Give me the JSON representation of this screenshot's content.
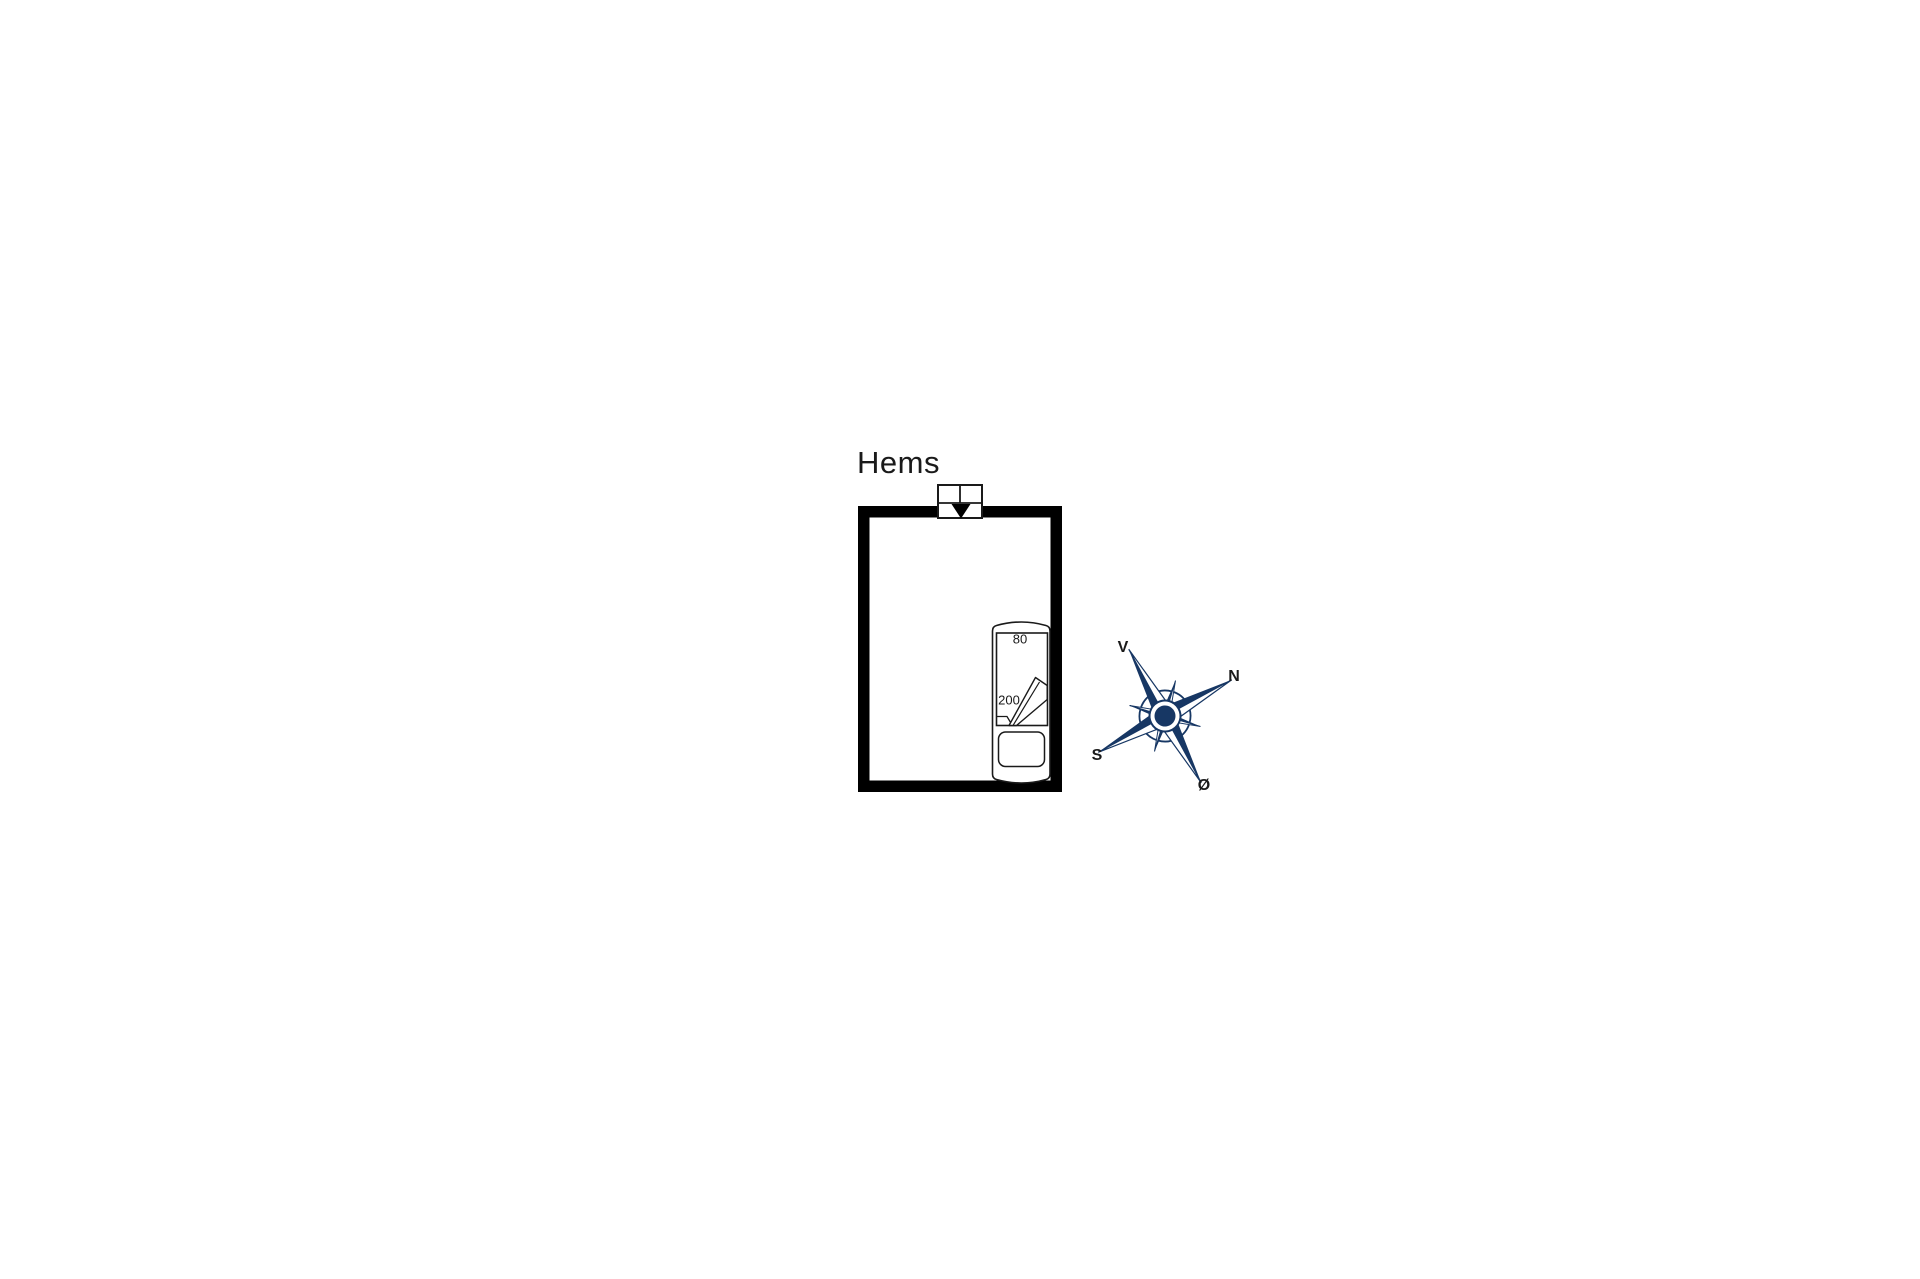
{
  "colors": {
    "navy": "#173764",
    "wall": "#000000",
    "line": "#1a1a1a",
    "text": "#1a1a1a",
    "bg": "#ffffff"
  },
  "floor_plan": {
    "room_label": "Hems",
    "bed": {
      "width_label": "80",
      "length_label": "200"
    }
  },
  "compass": {
    "west_label": "V",
    "north_label": "N",
    "south_label": "S",
    "east_label": "Ø"
  },
  "icons": {
    "window": "roof-window-icon",
    "bed": "single-bed-icon",
    "compass": "compass-rose-icon"
  }
}
